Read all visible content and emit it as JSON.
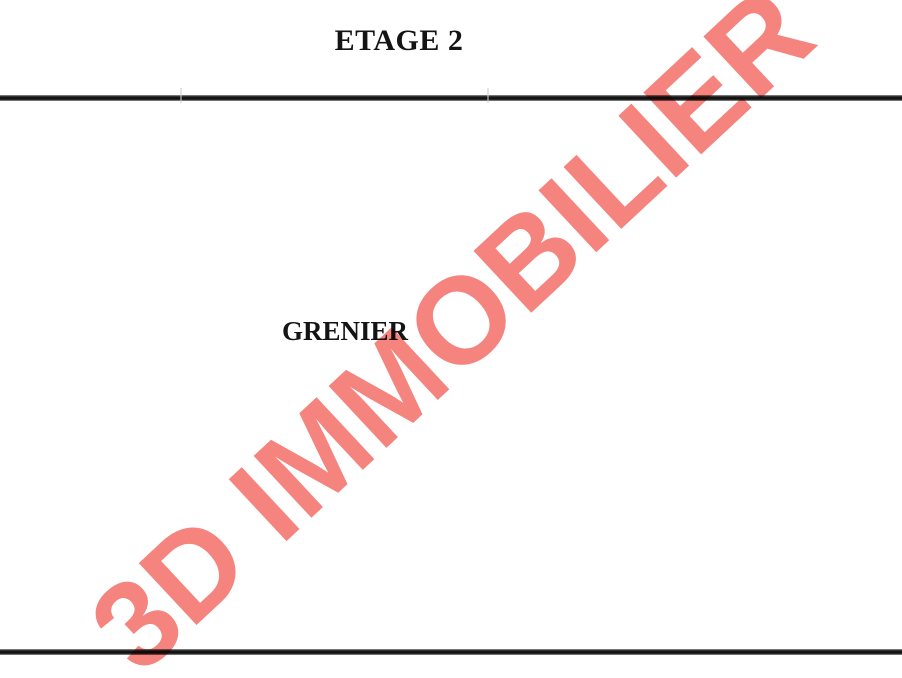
{
  "page": {
    "title": "ETAGE 2"
  },
  "plan": {
    "room_label": "GRENIER",
    "wall_color": "#0c0c0c"
  },
  "watermark": {
    "text": "3D IMMOBILIER",
    "color": "#F5837E"
  }
}
